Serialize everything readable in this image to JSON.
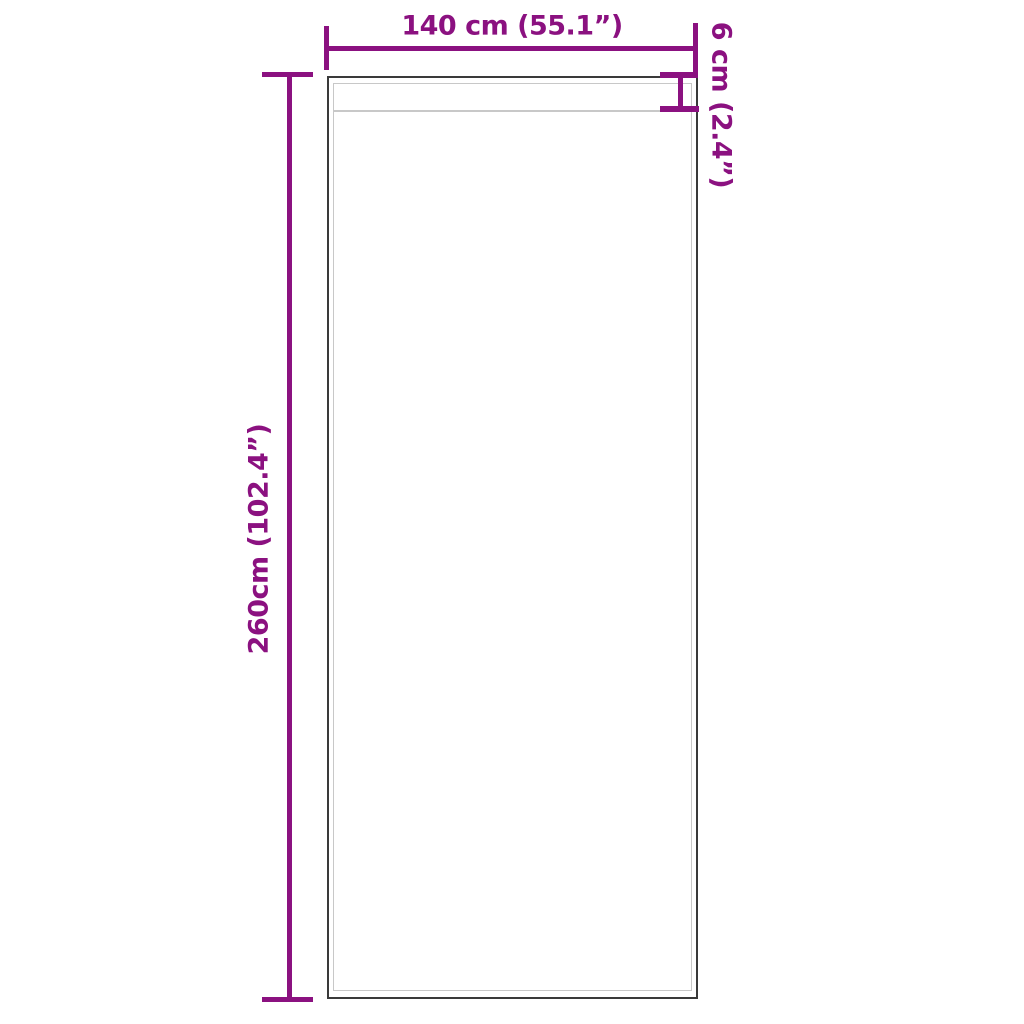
{
  "colors": {
    "background": "#ffffff",
    "accent": "#8B1180",
    "panel-outline": "#3a3a3a",
    "panel-inner-line": "#c8c8c8"
  },
  "diagram": {
    "type": "product-dimension-diagram",
    "subject": "curtain panel with rod pocket",
    "labels": {
      "width": "140 cm (55.1”)",
      "height": "260cm (102.4”)",
      "pocket": "6 cm (2.4”)"
    },
    "measurements": {
      "width_cm": 140,
      "width_in": 55.1,
      "height_cm": 260,
      "height_in": 102.4,
      "pocket_cm": 6,
      "pocket_in": 2.4
    }
  }
}
